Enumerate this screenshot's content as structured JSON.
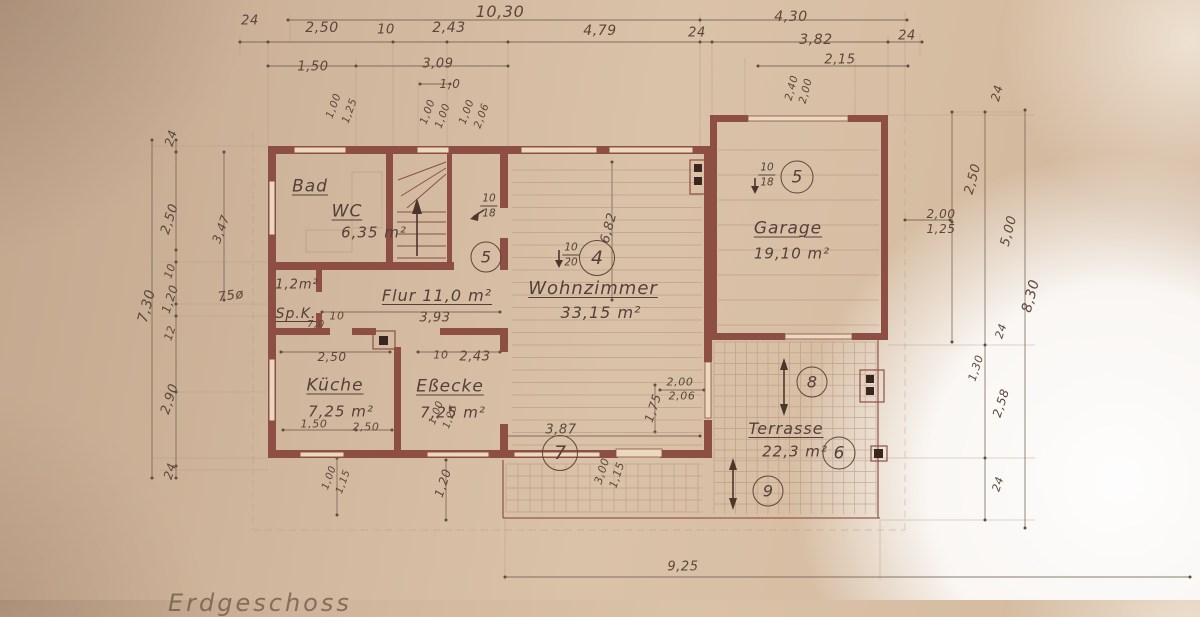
{
  "plan": {
    "floor_label": "Erdgeschoss"
  },
  "colors": {
    "paper": "#d6bda2",
    "wall": "#8d4f44",
    "ink": "#5c463c",
    "dimline": "#6f5a49",
    "grid": "#b08a76"
  },
  "room_labels": [
    {
      "t": "Bad",
      "x": 310,
      "y": 187,
      "s": 17,
      "u": 1
    },
    {
      "t": "WC",
      "x": 347,
      "y": 212,
      "s": 17,
      "u": 1
    },
    {
      "t": "6,35 m²",
      "x": 374,
      "y": 233,
      "s": 15
    },
    {
      "t": "1,2m²",
      "x": 297,
      "y": 285,
      "s": 13
    },
    {
      "t": "Sp.K.",
      "x": 296,
      "y": 314,
      "s": 14,
      "u": 1
    },
    {
      "t": "Flur 11,0 m²",
      "x": 437,
      "y": 296,
      "s": 16,
      "u": 1
    },
    {
      "t": "Küche",
      "x": 335,
      "y": 386,
      "s": 17,
      "u": 1
    },
    {
      "t": "7,25 m²",
      "x": 341,
      "y": 412,
      "s": 15
    },
    {
      "t": "Eßecke",
      "x": 450,
      "y": 387,
      "s": 17,
      "u": 1
    },
    {
      "t": "7,25 m²",
      "x": 453,
      "y": 413,
      "s": 15
    },
    {
      "t": "Wohnzimmer",
      "x": 593,
      "y": 289,
      "s": 18,
      "u": 1
    },
    {
      "t": "33,15 m²",
      "x": 601,
      "y": 313,
      "s": 16
    },
    {
      "t": "Garage",
      "x": 788,
      "y": 229,
      "s": 17,
      "u": 1
    },
    {
      "t": "19,10 m²",
      "x": 792,
      "y": 254,
      "s": 15
    },
    {
      "t": "Terrasse",
      "x": 786,
      "y": 429,
      "s": 16,
      "u": 1
    },
    {
      "t": "22,3 m²",
      "x": 795,
      "y": 452,
      "s": 15
    }
  ],
  "markers": [
    {
      "n": "4",
      "x": 597,
      "y": 258,
      "d": 36
    },
    {
      "n": "5",
      "x": 486,
      "y": 257,
      "d": 31
    },
    {
      "n": "5",
      "x": 797,
      "y": 177,
      "d": 33
    },
    {
      "n": "6",
      "x": 839,
      "y": 453,
      "d": 33
    },
    {
      "n": "7",
      "x": 560,
      "y": 453,
      "d": 36
    },
    {
      "n": "8",
      "x": 812,
      "y": 382,
      "d": 31
    },
    {
      "n": "9",
      "x": 768,
      "y": 491,
      "d": 31
    }
  ],
  "fractions": [
    {
      "top": "10",
      "bot": "18",
      "x": 489,
      "y": 206
    },
    {
      "top": "10",
      "bot": "20",
      "x": 571,
      "y": 255
    },
    {
      "top": "10",
      "bot": "18",
      "x": 767,
      "y": 175
    }
  ],
  "annotations": [
    {
      "t": "10,30",
      "x": 500,
      "y": 12,
      "s": 16
    },
    {
      "t": "24",
      "x": 250,
      "y": 21,
      "s": 13
    },
    {
      "t": "2,50",
      "x": 322,
      "y": 28,
      "s": 14
    },
    {
      "t": "10",
      "x": 386,
      "y": 30,
      "s": 13
    },
    {
      "t": "2,43",
      "x": 449,
      "y": 28,
      "s": 14
    },
    {
      "t": "4,79",
      "x": 600,
      "y": 31,
      "s": 14
    },
    {
      "t": "24",
      "x": 697,
      "y": 33,
      "s": 13
    },
    {
      "t": "4,30",
      "x": 791,
      "y": 17,
      "s": 14
    },
    {
      "t": "3,82",
      "x": 816,
      "y": 40,
      "s": 14
    },
    {
      "t": "24",
      "x": 907,
      "y": 36,
      "s": 13
    },
    {
      "t": "2,15",
      "x": 840,
      "y": 60,
      "s": 13
    },
    {
      "t": "1,50",
      "x": 313,
      "y": 67,
      "s": 13
    },
    {
      "t": "3,09",
      "x": 438,
      "y": 64,
      "s": 13
    },
    {
      "t": "1,0",
      "x": 450,
      "y": 84,
      "s": 12
    },
    {
      "t": "1,00",
      "x": 334,
      "y": 106,
      "r": -70,
      "s": 10.5
    },
    {
      "t": "1,25",
      "x": 350,
      "y": 111,
      "r": -70,
      "s": 10.5
    },
    {
      "t": "1,00",
      "x": 428,
      "y": 112,
      "r": -70,
      "s": 10.5
    },
    {
      "t": "1,00",
      "x": 443,
      "y": 116,
      "r": -70,
      "s": 10.5
    },
    {
      "t": "1,00",
      "x": 467,
      "y": 112,
      "r": -70,
      "s": 10.5
    },
    {
      "t": "2,06",
      "x": 482,
      "y": 116,
      "r": -70,
      "s": 10.5
    },
    {
      "t": "2,40",
      "x": 792,
      "y": 88,
      "r": -75,
      "s": 10.5
    },
    {
      "t": "2,00",
      "x": 806,
      "y": 91,
      "r": -75,
      "s": 10.5
    },
    {
      "t": "24",
      "x": 997,
      "y": 93,
      "r": -75,
      "s": 12
    },
    {
      "t": "7,30",
      "x": 147,
      "y": 306,
      "r": -75,
      "s": 14
    },
    {
      "t": "24",
      "x": 171,
      "y": 138,
      "r": -72,
      "s": 12
    },
    {
      "t": "2,50",
      "x": 170,
      "y": 219,
      "r": -72,
      "s": 13
    },
    {
      "t": "3,47",
      "x": 221,
      "y": 229,
      "r": -70,
      "s": 12
    },
    {
      "t": "10",
      "x": 170,
      "y": 271,
      "r": -72,
      "s": 11
    },
    {
      "t": "1,20",
      "x": 170,
      "y": 299,
      "r": -72,
      "s": 12
    },
    {
      "t": "12",
      "x": 170,
      "y": 333,
      "r": -72,
      "s": 11
    },
    {
      "t": "2,90",
      "x": 170,
      "y": 399,
      "r": -72,
      "s": 13
    },
    {
      "t": "24",
      "x": 170,
      "y": 471,
      "r": -72,
      "s": 12
    },
    {
      "t": "75ø",
      "x": 231,
      "y": 296,
      "r": -8,
      "s": 13
    },
    {
      "t": "2,00",
      "x": 941,
      "y": 214,
      "s": 12
    },
    {
      "t": "1,25",
      "x": 941,
      "y": 229,
      "s": 12
    },
    {
      "t": "2,50",
      "x": 973,
      "y": 179,
      "r": -75,
      "s": 13
    },
    {
      "t": "5,00",
      "x": 1009,
      "y": 231,
      "r": -75,
      "s": 13
    },
    {
      "t": "8,30",
      "x": 1031,
      "y": 296,
      "r": -75,
      "s": 14
    },
    {
      "t": "24",
      "x": 1001,
      "y": 331,
      "r": -72,
      "s": 11
    },
    {
      "t": "1,30",
      "x": 976,
      "y": 368,
      "r": -72,
      "s": 11
    },
    {
      "t": "2,58",
      "x": 1001,
      "y": 403,
      "r": -72,
      "s": 12
    },
    {
      "t": "24",
      "x": 998,
      "y": 484,
      "r": -72,
      "s": 11
    },
    {
      "t": "9,25",
      "x": 683,
      "y": 567,
      "s": 13
    },
    {
      "t": "3,93",
      "x": 435,
      "y": 318,
      "s": 13
    },
    {
      "t": "10",
      "x": 337,
      "y": 316,
      "s": 11
    },
    {
      "t": "7,0",
      "x": 316,
      "y": 325,
      "s": 10
    },
    {
      "t": "2,50",
      "x": 332,
      "y": 357,
      "s": 12
    },
    {
      "t": "10",
      "x": 441,
      "y": 355,
      "s": 11
    },
    {
      "t": "2,43",
      "x": 475,
      "y": 357,
      "s": 13
    },
    {
      "t": "1,50",
      "x": 314,
      "y": 424,
      "s": 11
    },
    {
      "t": "2,50",
      "x": 366,
      "y": 427,
      "s": 11
    },
    {
      "t": "1,00",
      "x": 437,
      "y": 413,
      "r": -70,
      "s": 10
    },
    {
      "t": "1,25",
      "x": 451,
      "y": 417,
      "r": -70,
      "s": 10
    },
    {
      "t": "1,00",
      "x": 330,
      "y": 478,
      "r": -70,
      "s": 10
    },
    {
      "t": "1,15",
      "x": 344,
      "y": 482,
      "r": -70,
      "s": 10
    },
    {
      "t": "1,20",
      "x": 443,
      "y": 483,
      "r": -72,
      "s": 12
    },
    {
      "t": "3,87",
      "x": 561,
      "y": 430,
      "s": 13
    },
    {
      "t": "3,00",
      "x": 602,
      "y": 471,
      "r": -72,
      "s": 11
    },
    {
      "t": "1,15",
      "x": 617,
      "y": 475,
      "r": -72,
      "s": 11
    },
    {
      "t": "1,75",
      "x": 653,
      "y": 408,
      "r": -72,
      "s": 12
    },
    {
      "t": "2,00",
      "x": 680,
      "y": 382,
      "s": 11
    },
    {
      "t": "2,06",
      "x": 682,
      "y": 396,
      "s": 11
    },
    {
      "t": "6,82",
      "x": 609,
      "y": 228,
      "r": -75,
      "s": 13
    }
  ]
}
